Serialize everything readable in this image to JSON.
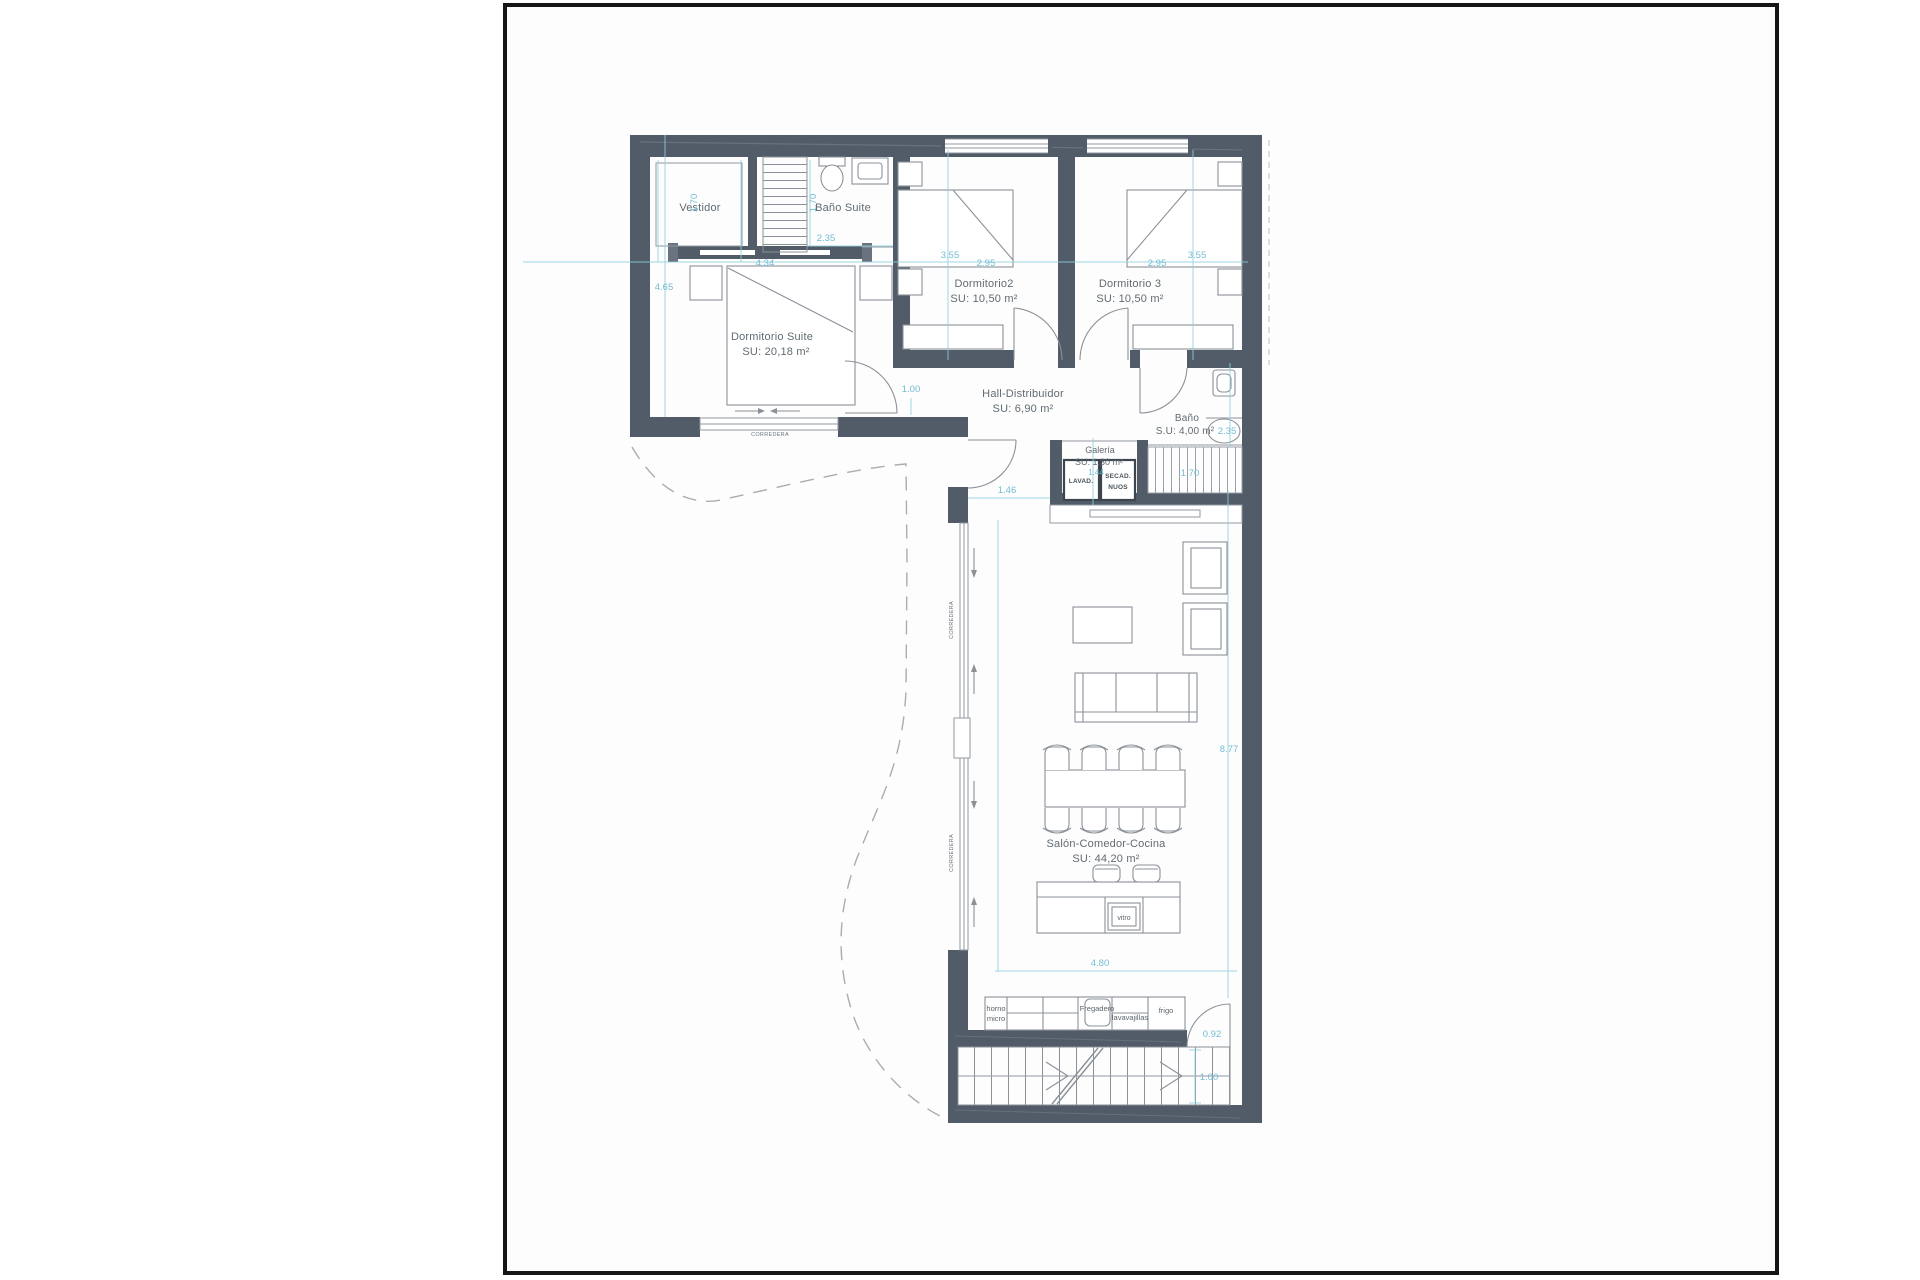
{
  "document": {
    "type": "architectural floor plan"
  },
  "colors": {
    "wall": "#515c68",
    "wall_light": "#6a737d",
    "page_border": "#161616",
    "paper": "#fdfdfd",
    "line": "#9199a1",
    "furniture": "#8b9198",
    "dimension": "#72bdd2",
    "label": "#616b72",
    "terrace_dashed": "#a8adb2"
  },
  "rooms": {
    "vestidor": {
      "name": "Vestidor",
      "width": "1.70"
    },
    "bano_suite": {
      "name": "Baño Suite",
      "width": "1.70",
      "depth": "2.35"
    },
    "dormitorio_suite": {
      "name": "Dormitorio Suite",
      "area": "SU: 20,18 m²",
      "width": "4.34",
      "height": "4.65"
    },
    "dormitorio2": {
      "name": "Dormitorio2",
      "area": "SU: 10,50 m²",
      "depth": "3.55",
      "width": "2.95"
    },
    "dormitorio3": {
      "name": "Dormitorio 3",
      "area": "SU: 10,50 m²",
      "depth": "3.55",
      "width": "2.95"
    },
    "hall": {
      "name": "Hall-Distribuidor",
      "area": "SU: 6,90 m²",
      "width": "1.00"
    },
    "bano": {
      "name": "Baño",
      "area": "S.U: 4,00 m²",
      "width": "2.35"
    },
    "galeria": {
      "name": "Galería",
      "area": "SU: 1,30 m²",
      "width": "1.44"
    },
    "salon": {
      "name": "Salón-Comedor-Cocina",
      "area": "SU: 44,20 m²",
      "height": "8.77",
      "width": "4.80"
    }
  },
  "dims": {
    "stair_upper": "1.70",
    "passage": "1.46",
    "kitchen_door": "0.92",
    "ext_stair": "1.00"
  },
  "labels": {
    "corredera": "CORREDERA",
    "lavadora": "LAVAD.",
    "secadora_1": "SECAD.",
    "secadora_2": "NUOS",
    "vitro": "vitro",
    "horno_1": "horno",
    "horno_2": "micro",
    "fregadero": "Fregadero",
    "lavavajillas": "lavavajillas",
    "frigo": "frigo"
  }
}
